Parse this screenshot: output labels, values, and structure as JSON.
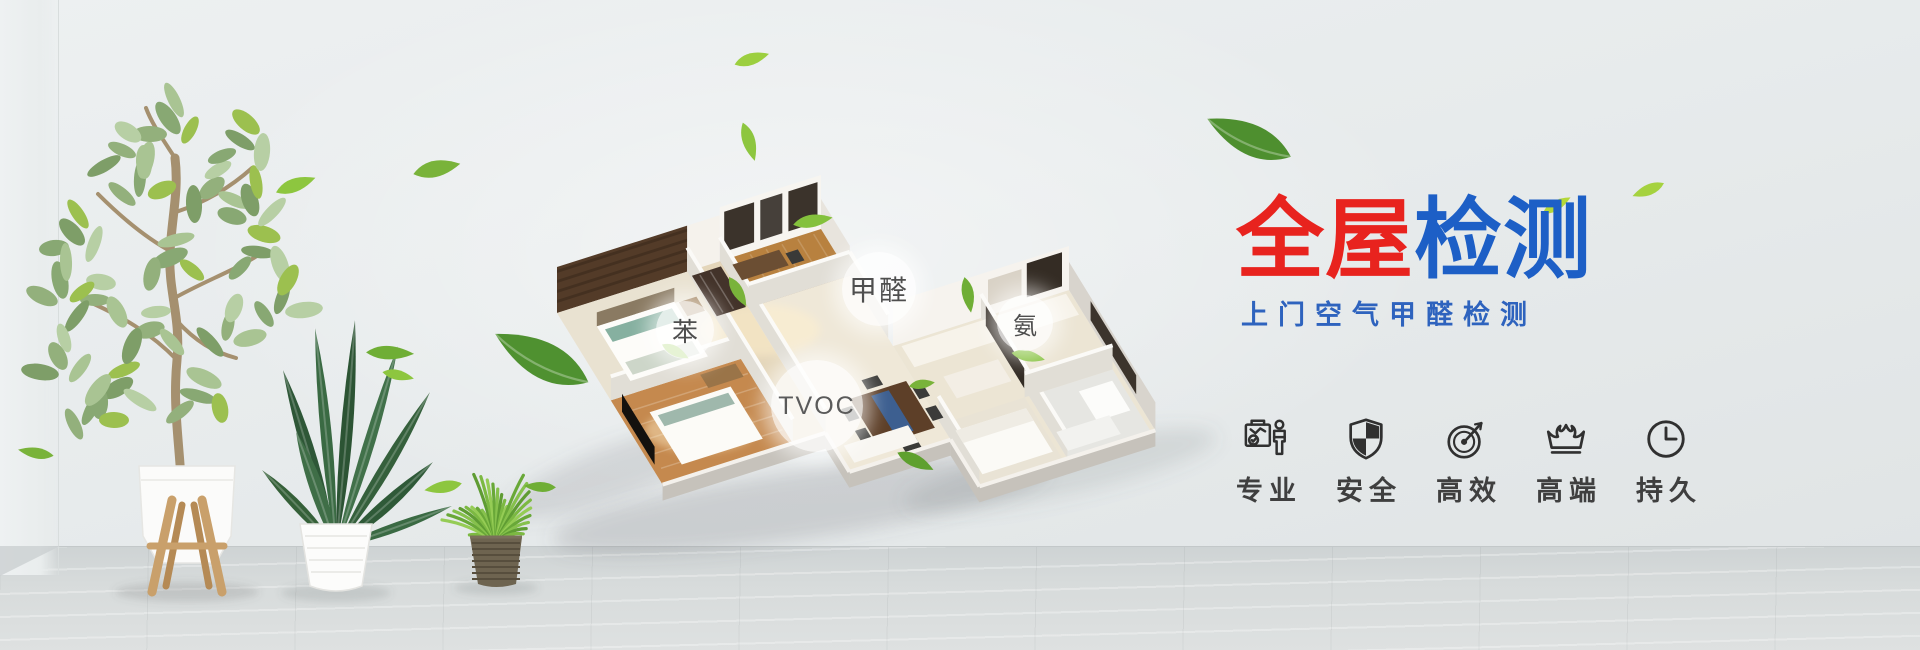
{
  "banner": {
    "title": [
      {
        "text": "全屋",
        "color": "#e8231e"
      },
      {
        "text": "检测",
        "color": "#1d5fc6"
      }
    ],
    "subtitle": "上门空气甲醛检测",
    "pollutants": [
      {
        "text": "苯"
      },
      {
        "text": "甲醛"
      },
      {
        "text": "氨"
      },
      {
        "text": "TVOC"
      }
    ],
    "features": [
      {
        "label": "专业",
        "icon": "certificate-person-icon"
      },
      {
        "label": "安全",
        "icon": "shield-icon"
      },
      {
        "label": "高效",
        "icon": "gauge-icon"
      },
      {
        "label": "高端",
        "icon": "crown-icon"
      },
      {
        "label": "持久",
        "icon": "clock-icon"
      }
    ],
    "colors": {
      "title_red": "#e8231e",
      "title_blue": "#1d5fc6",
      "subtitle_blue": "#2e63be",
      "icon_dark": "#303030",
      "leaf_green": "#8dc63f"
    }
  }
}
